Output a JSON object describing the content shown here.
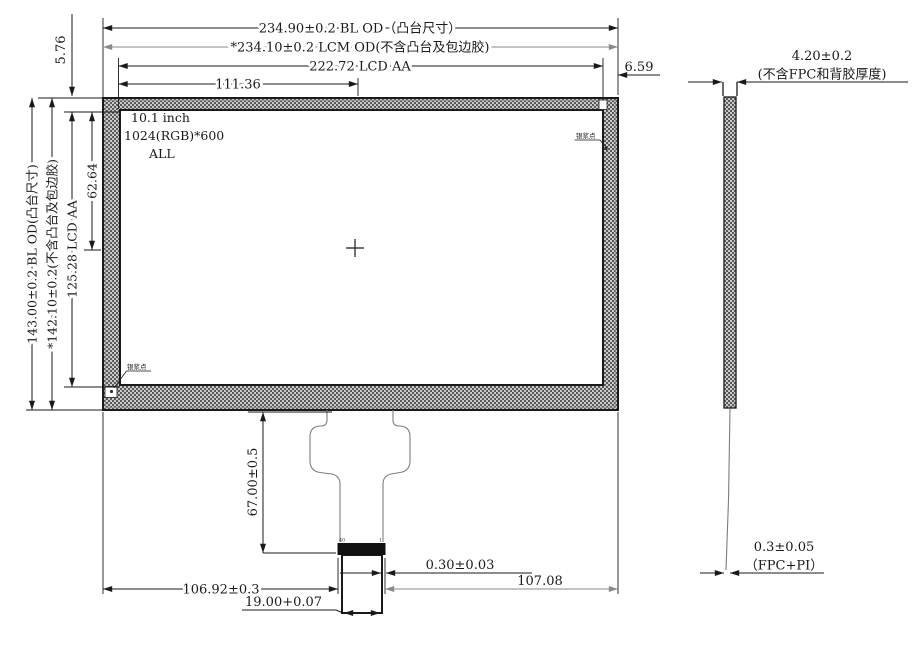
{
  "front": {
    "center_label": {
      "line1": "10.1 inch",
      "line2": "1024(RGB)*600",
      "line3": "ALL"
    },
    "silver_dot_top_right": "银浆点",
    "silver_dot_bottom_left": "银浆点",
    "dims": {
      "width_bl": "234.90±0.2 BL OD（凸台尺寸）",
      "width_lcm": "*234.10±0.2 LCM OD(不含凸台及包边胶)",
      "width_aa": "222.72 LCD AA",
      "width_half": "111.36",
      "edge_offset_right": "6.59",
      "edge_offset_top_left": "5.76",
      "height_bl": "143.00±0.2 BL OD(凸台尺寸)",
      "height_lcm": "*142.10±0.2(不含凸台及包边胶)",
      "height_aa": "125.28 LCD AA",
      "height_half": "62.64"
    }
  },
  "fpc": {
    "pin_left": "40",
    "pin_right": "1",
    "dims": {
      "drop_height": "67.00±0.5",
      "offset_left": "106.92±0.3",
      "tail_width": "19.00+0.07",
      "connector_offset": "0.30±0.03",
      "offset_right": "107.08"
    }
  },
  "side": {
    "dims": {
      "thickness": "4.20±0.2",
      "thickness_note": "(不含FPC和背胶厚度)",
      "fpc_thickness": "0.3±0.05",
      "fpc_note": "（FPC+PI）"
    }
  },
  "colors": {
    "line": "#1a1a1a",
    "gray_line": "#8a8a8a",
    "hatch_dark": "#5a5a5a",
    "hatch_light": "#c9c9c9"
  }
}
